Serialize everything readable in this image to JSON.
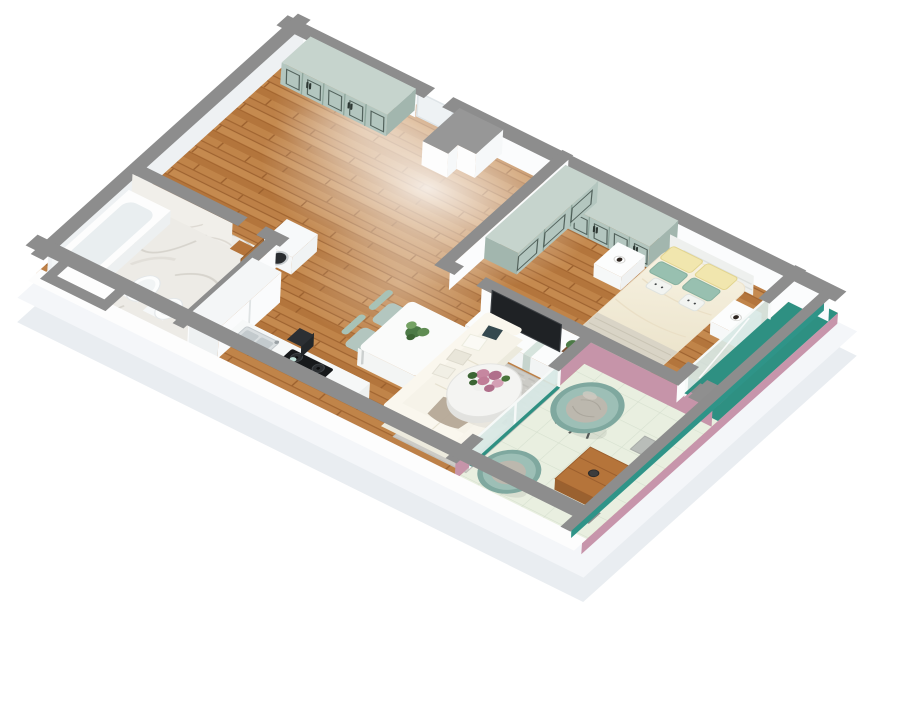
{
  "scene": {
    "kind": "3d-apartment-floor-plan",
    "style": "dollhouse-axonometric-render",
    "background": "#ffffff"
  },
  "colors": {
    "wall_top": "#8d8d8d",
    "wall_top_light": "#979797",
    "wall_face": "#fbfcfd",
    "wall_face_shade": "#eef1f3",
    "slab": "#f4f6f9",
    "slab_deep": "#e9edf1",
    "floor_wood": "#b87a41",
    "floor_wood_line": "#a06430",
    "marble": "#edebe6",
    "marble_wall": "#f1efea",
    "tile": "#e9efe0",
    "tile_line": "#d6e0cf",
    "teal_strip": "#2e9082",
    "teal_parapet": "#2f9488",
    "teal_track": "#2e9082",
    "pink": "#c694a9",
    "pink_outer": "#c795ab",
    "sage": "#b3c6bf",
    "sage_top": "#c6d4cd",
    "sage_shade": "#a2b6ae",
    "glass": "#d8e8e5",
    "duvet_light": "#f8f3e3",
    "duvet_dark": "#ece4cc",
    "pillow_yellow": "#f1e6ae",
    "pillow_teal": "#98c0b0",
    "rug": "#cccbc6",
    "sofa": "#f6f3e9",
    "tv": "#1f2225",
    "wood_furniture": "#b5743a",
    "appliance_dark": "#17191b",
    "papasan": "#9dbfb6",
    "papasan_cushion": "#bcb8ae",
    "plant_green": "#4c7a46",
    "flower_pink": "#c687a0"
  },
  "rooms": [
    {
      "name": "entry-hall",
      "floor": "wood",
      "items": [
        "wardrobe-5-door",
        "entrance-door",
        "closet-block",
        "washing-machine"
      ]
    },
    {
      "name": "bathroom",
      "floor": "marble",
      "items": [
        "bathtub",
        "toilet",
        "bidet",
        "wood-vanity",
        "open-wood-door"
      ]
    },
    {
      "name": "kitchen",
      "floor": "wood",
      "items": [
        "tall-cabinet",
        "counter",
        "sink",
        "cooktop",
        "oven",
        "stool"
      ]
    },
    {
      "name": "living-dining",
      "floor": "wood",
      "items": [
        "dining-table",
        "four-chairs",
        "plant-centerpiece",
        "l-sofa",
        "pillows",
        "throw",
        "gray-rug",
        "round-coffee-table",
        "flower-bouquet",
        "tv",
        "tv-console",
        "vases"
      ]
    },
    {
      "name": "bedroom",
      "floor": "wood",
      "items": [
        "corner-wardrobe",
        "double-bed",
        "headboard",
        "yellow-pillows",
        "teal-pillows",
        "cat-cushions",
        "nightstand-left",
        "nightstand-right",
        "coffee-cups"
      ]
    },
    {
      "name": "balcony",
      "floor": "tile",
      "items": [
        "papasan-chair-1",
        "papasan-chair-2",
        "wood-low-table",
        "doormat",
        "sliding-glass-door-living",
        "sliding-glass-door-bedroom",
        "teal-parapet",
        "pink-walls"
      ]
    }
  ]
}
